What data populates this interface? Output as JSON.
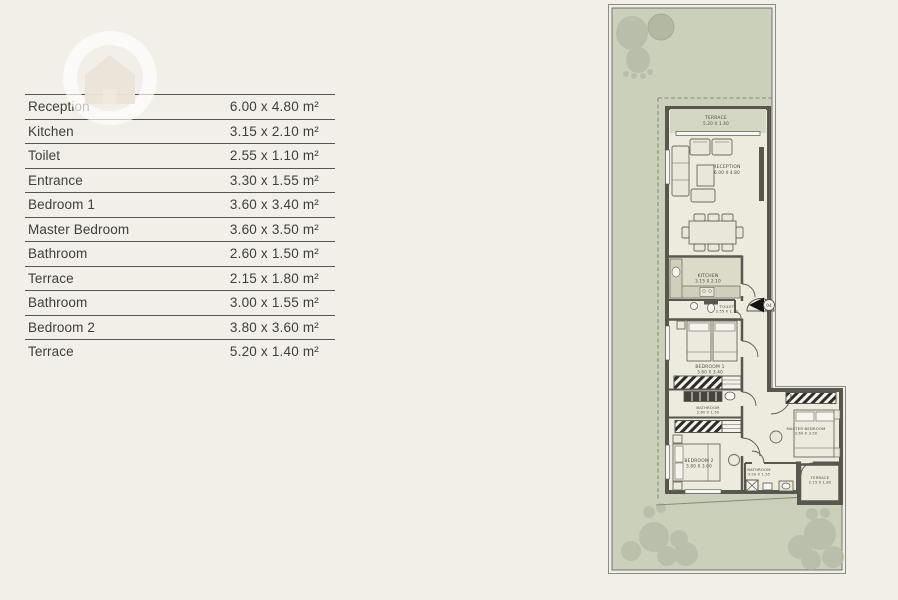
{
  "table": {
    "rows": [
      {
        "label": "Reception",
        "value": "6.00 x 4.80 m²"
      },
      {
        "label": "Kitchen",
        "value": "3.15 x 2.10 m²"
      },
      {
        "label": "Toilet",
        "value": "2.55 x 1.10 m²"
      },
      {
        "label": "Entrance",
        "value": "3.30 x 1.55 m²"
      },
      {
        "label": "Bedroom 1",
        "value": "3.60 x 3.40 m²"
      },
      {
        "label": "Master Bedroom",
        "value": "3.60 x 3.50 m²"
      },
      {
        "label": "Bathroom",
        "value": "2.60 x 1.50 m²"
      },
      {
        "label": "Terrace",
        "value": "2.15 x 1.80 m²"
      },
      {
        "label": "Bathroom",
        "value": "3.00 x 1.55 m²"
      },
      {
        "label": "Bedroom 2",
        "value": "3.80 x 3.60 m²"
      },
      {
        "label": "Terrace",
        "value": "5.20 x 1.40 m²"
      }
    ]
  },
  "plan": {
    "labels": {
      "terrace_top": {
        "name": "TERRACE",
        "dims": "5.20 X 1.40"
      },
      "reception": {
        "name": "RECEPTION",
        "dims": "6.00 X 4.80"
      },
      "kitchen": {
        "name": "KITCHEN",
        "dims": "3.15 X 2.10"
      },
      "toilet": {
        "name": "TOILET",
        "dims": "2.55 X 1.10"
      },
      "bedroom1": {
        "name": "BEDROOM 1",
        "dims": "3.60 X 3.40"
      },
      "bathroom1": {
        "name": "BATHROOM",
        "dims": "2.60 X 1.50"
      },
      "bedroom2": {
        "name": "BEDROOM 2",
        "dims": "3.80 X 3.60"
      },
      "bathroom2": {
        "name": "BATHROOM",
        "dims": "3.00 X 1.55"
      },
      "master": {
        "name": "MASTER BEDROOM",
        "dims": "3.60 X 3.50"
      },
      "terrace2": {
        "name": "TERRACE",
        "dims": "2.15 X 1.80"
      }
    },
    "entrance_badge": "04",
    "colors": {
      "background": "#f2efe9",
      "garden_green": "#cbd0bb",
      "tree_green": "#b5bba6",
      "wall": "#59564e",
      "floor": "#edeade",
      "kitchen_floor": "#dcdbc7"
    }
  }
}
